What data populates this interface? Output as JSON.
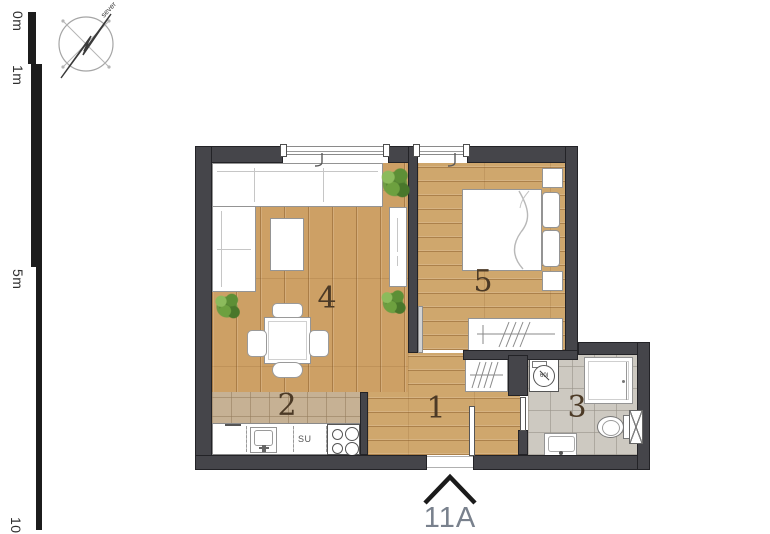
{
  "compass": {
    "north_label": "sever"
  },
  "scale_bar": {
    "labels": [
      "0m",
      "1m",
      "5m",
      "10m"
    ]
  },
  "rooms": {
    "hallway": {
      "number": "1"
    },
    "kitchen": {
      "number": "2"
    },
    "bathroom": {
      "number": "3"
    },
    "living_room": {
      "number": "4"
    },
    "bedroom": {
      "number": "5"
    }
  },
  "kitchen_labels": {
    "dishwasher": "SU"
  },
  "bathroom_labels": {
    "washing_machine": "60l"
  },
  "entrance": {
    "unit_label": "11A"
  },
  "colors": {
    "wall": "#45454a",
    "wood_floor": "#cda065",
    "kitchen_tile": "#c6b194",
    "bathroom_tile": "#cdc9c1",
    "room_number_text": "#4c3a26",
    "unit_label_text": "#79818d",
    "plant_green": "#5d8f36"
  }
}
